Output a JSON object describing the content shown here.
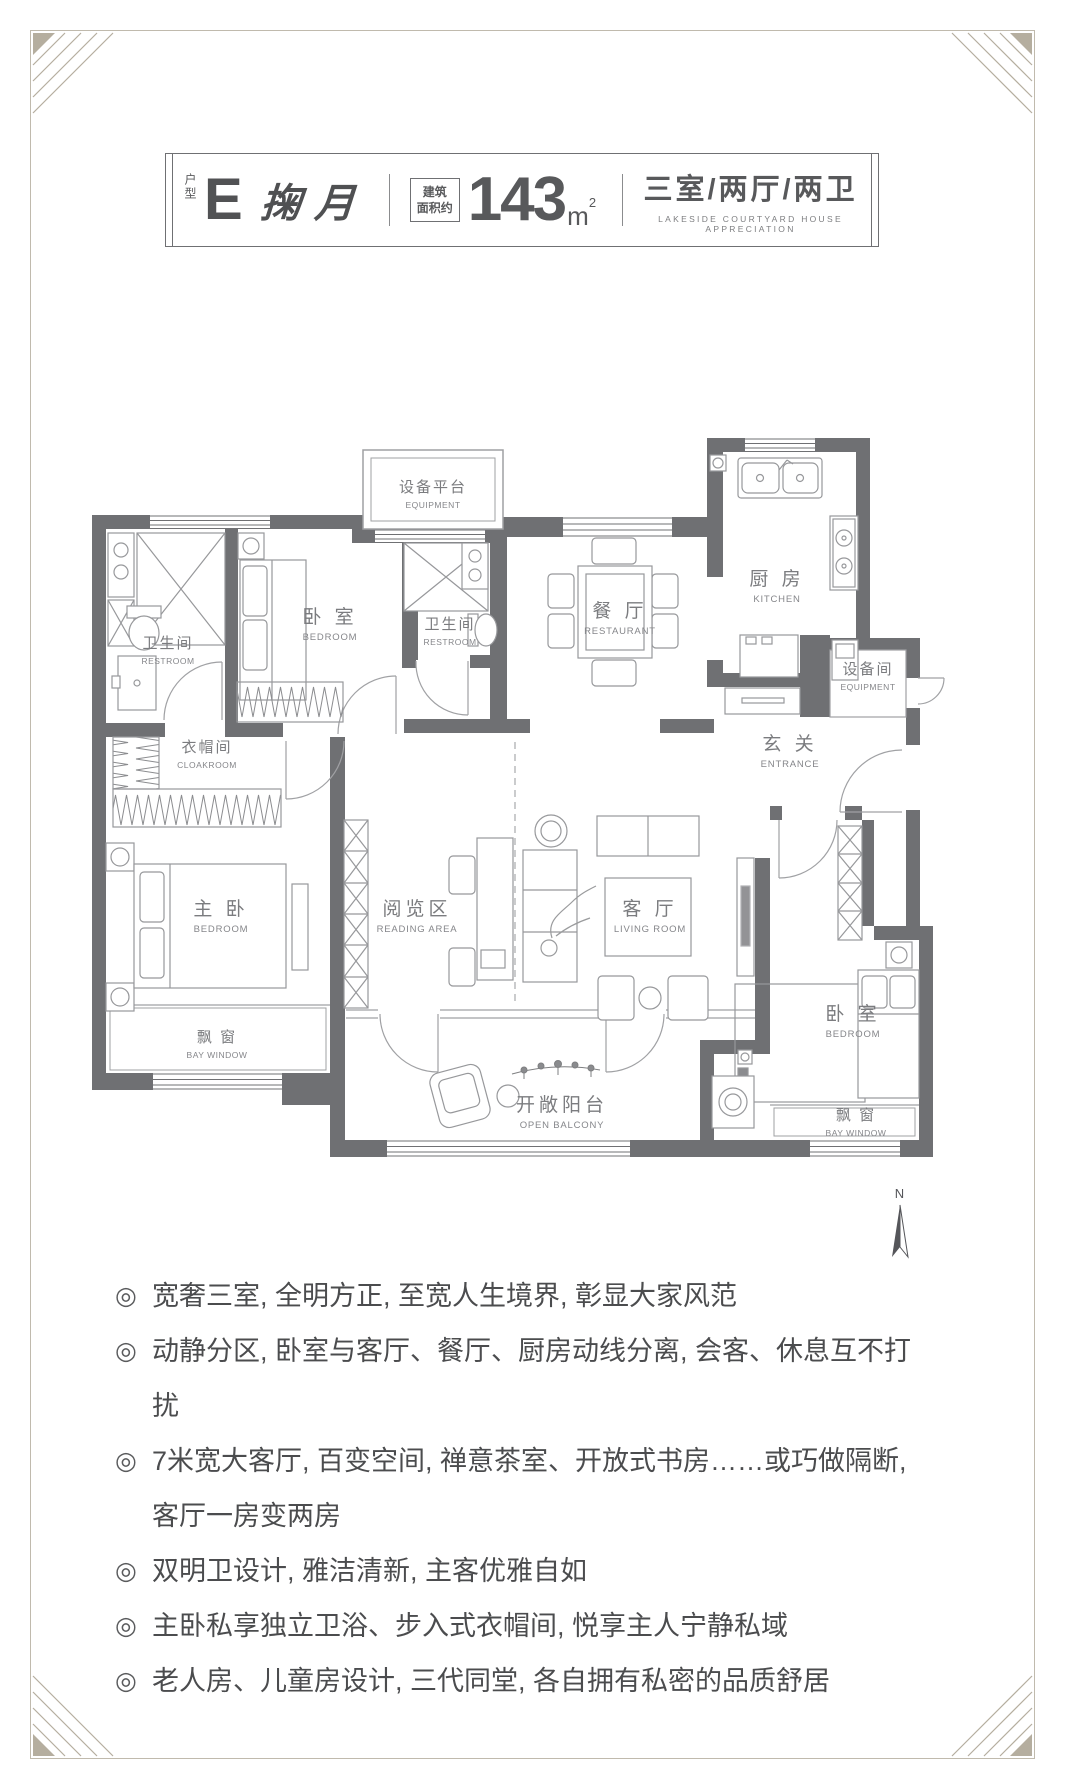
{
  "header": {
    "unit_type_label": "户型",
    "unit_letter": "E",
    "unit_name": "掬月",
    "area_prefix_line1": "建筑",
    "area_prefix_line2": "面积约",
    "area_value": "143",
    "area_unit": "m",
    "area_sup": "2",
    "layout_cn": "三室/两厅/两卫",
    "layout_en": "LAKESIDE COURTYARD HOUSE APPRECIATION"
  },
  "floorplan": {
    "compass_label": "N",
    "rooms": {
      "restroom1": {
        "cn": "卫生间",
        "en": "RESTROOM"
      },
      "bedroom1": {
        "cn": "卧 室",
        "en": "BEDROOM"
      },
      "equipment_platform": {
        "cn": "设备平台",
        "en": "EQUIPMENT"
      },
      "restroom2": {
        "cn": "卫生间",
        "en": "RESTROOM"
      },
      "dining": {
        "cn": "餐 厅",
        "en": "RESTAURANT"
      },
      "kitchen": {
        "cn": "厨 房",
        "en": "KITCHEN"
      },
      "equipment_room": {
        "cn": "设备间",
        "en": "EQUIPMENT"
      },
      "entrance": {
        "cn": "玄 关",
        "en": "ENTRANCE"
      },
      "cloakroom": {
        "cn": "衣帽间",
        "en": "CLOAKROOM"
      },
      "master_bedroom": {
        "cn": "主 卧",
        "en": "BEDROOM"
      },
      "reading_area": {
        "cn": "阅览区",
        "en": "READING AREA"
      },
      "living_room": {
        "cn": "客 厅",
        "en": "LIVING ROOM"
      },
      "bedroom2": {
        "cn": "卧 室",
        "en": "BEDROOM"
      },
      "bay_window_left": {
        "cn": "飘 窗",
        "en": "BAY WINDOW"
      },
      "open_balcony": {
        "cn": "开敞阳台",
        "en": "OPEN BALCONY"
      },
      "bay_window_right": {
        "cn": "飘 窗",
        "en": "BAY WINDOW"
      }
    }
  },
  "features": {
    "bullet_symbol": "◎",
    "items": [
      "宽奢三室, 全明方正, 至宽人生境界, 彰显大家风范",
      "动静分区, 卧室与客厅、餐厅、厨房动线分离, 会客、休息互不打扰",
      "7米宽大客厅, 百变空间, 禅意茶室、开放式书房……或巧做隔断, 客厅一房变两房",
      "双明卫设计, 雅洁清新, 主客优雅自如",
      "主卧私享独立卫浴、步入式衣帽间, 悦享主人宁静私域",
      "老人房、儿童房设计, 三代同堂, 各自拥有私密的品质舒居"
    ]
  },
  "colors": {
    "wall": "#6f7073",
    "furniture_line": "#97989b",
    "label": "#7b7c7f",
    "frame": "#c0baad",
    "text": "#4b4c4e"
  }
}
